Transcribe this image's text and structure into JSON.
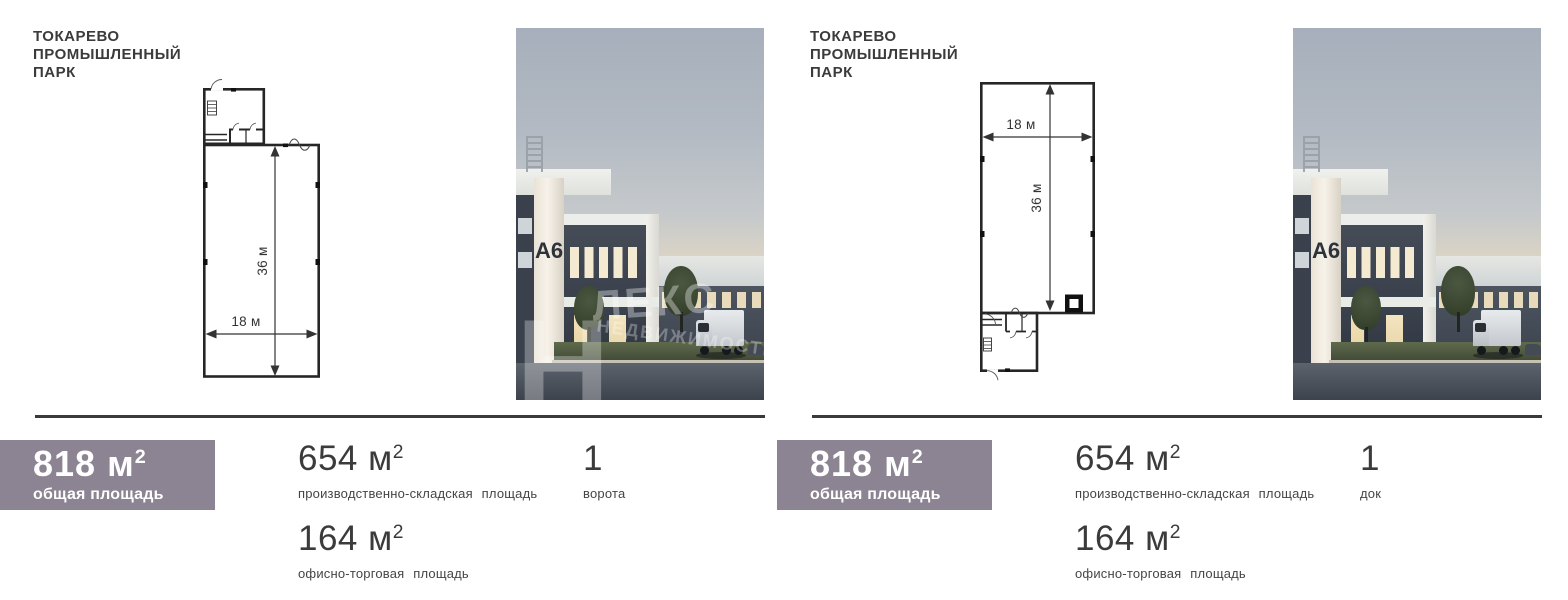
{
  "accent_color": "#8c8492",
  "panels": [
    {
      "title": {
        "line1": "ТОКАРЕВО",
        "line2": "ПРОМЫШЛЕННЫЙ",
        "line3": "ПАРК"
      },
      "plan": {
        "width_label": "18 м",
        "height_label": "36 м"
      },
      "photo": {
        "building_label": "A6",
        "watermark_letter": "Н",
        "watermark_line1": "ЛЕКС",
        "watermark_line2": "НЕДВИЖИМОСТЬ"
      },
      "stats": {
        "total": {
          "value": "818 м",
          "sup": "2",
          "label": "общая площадь"
        },
        "warehouse": {
          "value": "654 м",
          "sup": "2",
          "label": "производственно-складская площадь"
        },
        "office": {
          "value": "164 м",
          "sup": "2",
          "label": "офисно-торговая площадь"
        },
        "doors": {
          "value": "1",
          "label": "ворота"
        }
      }
    },
    {
      "title": {
        "line1": "ТОКАРЕВО",
        "line2": "ПРОМЫШЛЕННЫЙ",
        "line3": "ПАРК"
      },
      "plan": {
        "width_label": "18 м",
        "height_label": "36 м"
      },
      "photo": {
        "building_label": "A6",
        "watermark_letter": "",
        "watermark_line1": "",
        "watermark_line2": ""
      },
      "stats": {
        "total": {
          "value": "818 м",
          "sup": "2",
          "label": "общая площадь"
        },
        "warehouse": {
          "value": "654 м",
          "sup": "2",
          "label": "производственно-складская площадь"
        },
        "office": {
          "value": "164 м",
          "sup": "2",
          "label": "офисно-торговая площадь"
        },
        "doors": {
          "value": "1",
          "label": "док"
        }
      }
    }
  ]
}
